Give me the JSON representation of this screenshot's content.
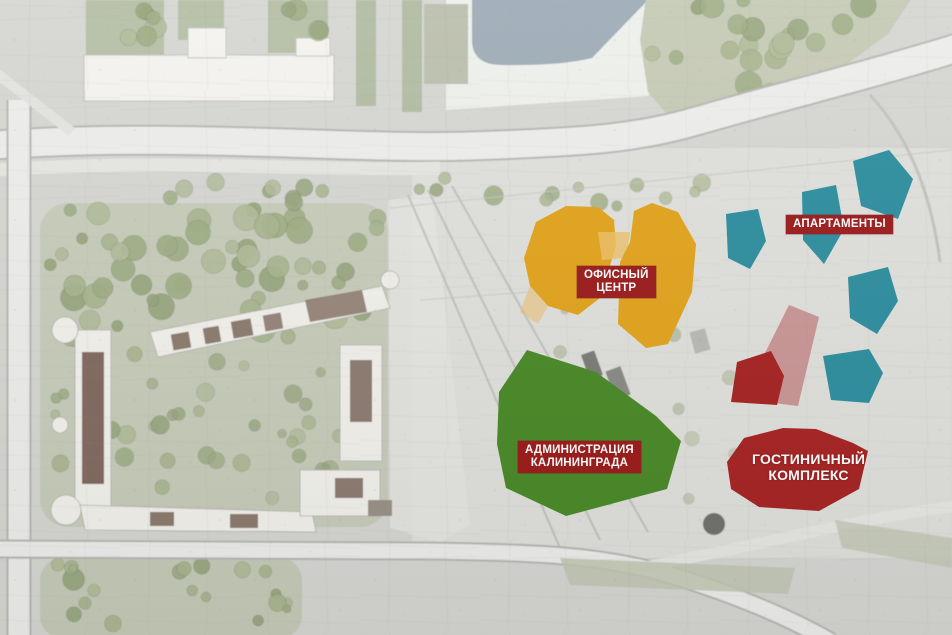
{
  "labels": {
    "office": {
      "line1": "ОФИСНЫЙ",
      "line2": "ЦЕНТР"
    },
    "apartments": {
      "text": "АПАРТАМЕНТЫ"
    },
    "administration": {
      "line1": "АДМИНИСТРАЦИЯ",
      "line2": "КАЛИНИНГРАДА"
    },
    "hotel": {
      "line1": "ГОСТИНИЧНЫЙ",
      "line2": "КОМПЛЕКС"
    }
  },
  "colors": {
    "office_zone": "#E3A41E",
    "office_zone_light": "#EDC069",
    "apartments_zone": "#2E8F9F",
    "administration_zone": "#4A8A28",
    "hotel_zone": "#A82424",
    "hotel_zone_overlay": "#BC6B6B",
    "badge_bg": "#9C1C1C",
    "label_text": "#FFFFFF"
  }
}
